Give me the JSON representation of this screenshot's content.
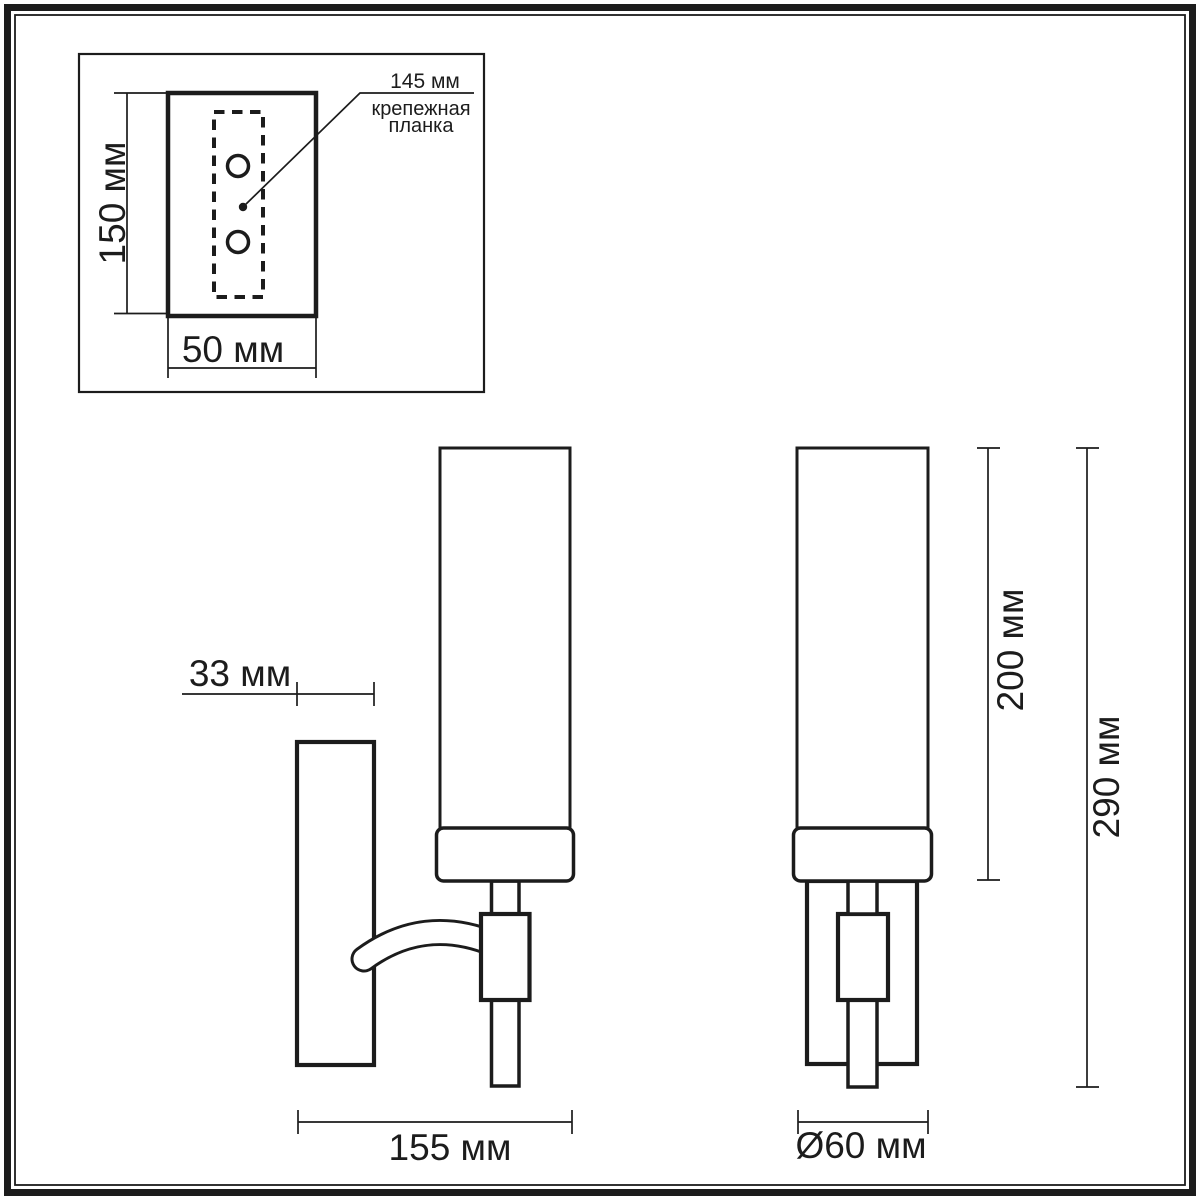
{
  "colors": {
    "ink": "#1c1c1c",
    "paper": "#ffffff"
  },
  "top_view_inset": {
    "plate_height_label": "150 мм",
    "plate_width_label": "50 мм",
    "callout": {
      "value": "145 мм",
      "caption_line1": "крепежная",
      "caption_line2": "планка"
    }
  },
  "side_view": {
    "plate_depth_label": "33 мм",
    "overall_depth_label": "155 мм"
  },
  "front_view": {
    "shade_height_label": "200 мм",
    "overall_height_label": "290 мм",
    "diameter_label": "Ø60 мм"
  }
}
